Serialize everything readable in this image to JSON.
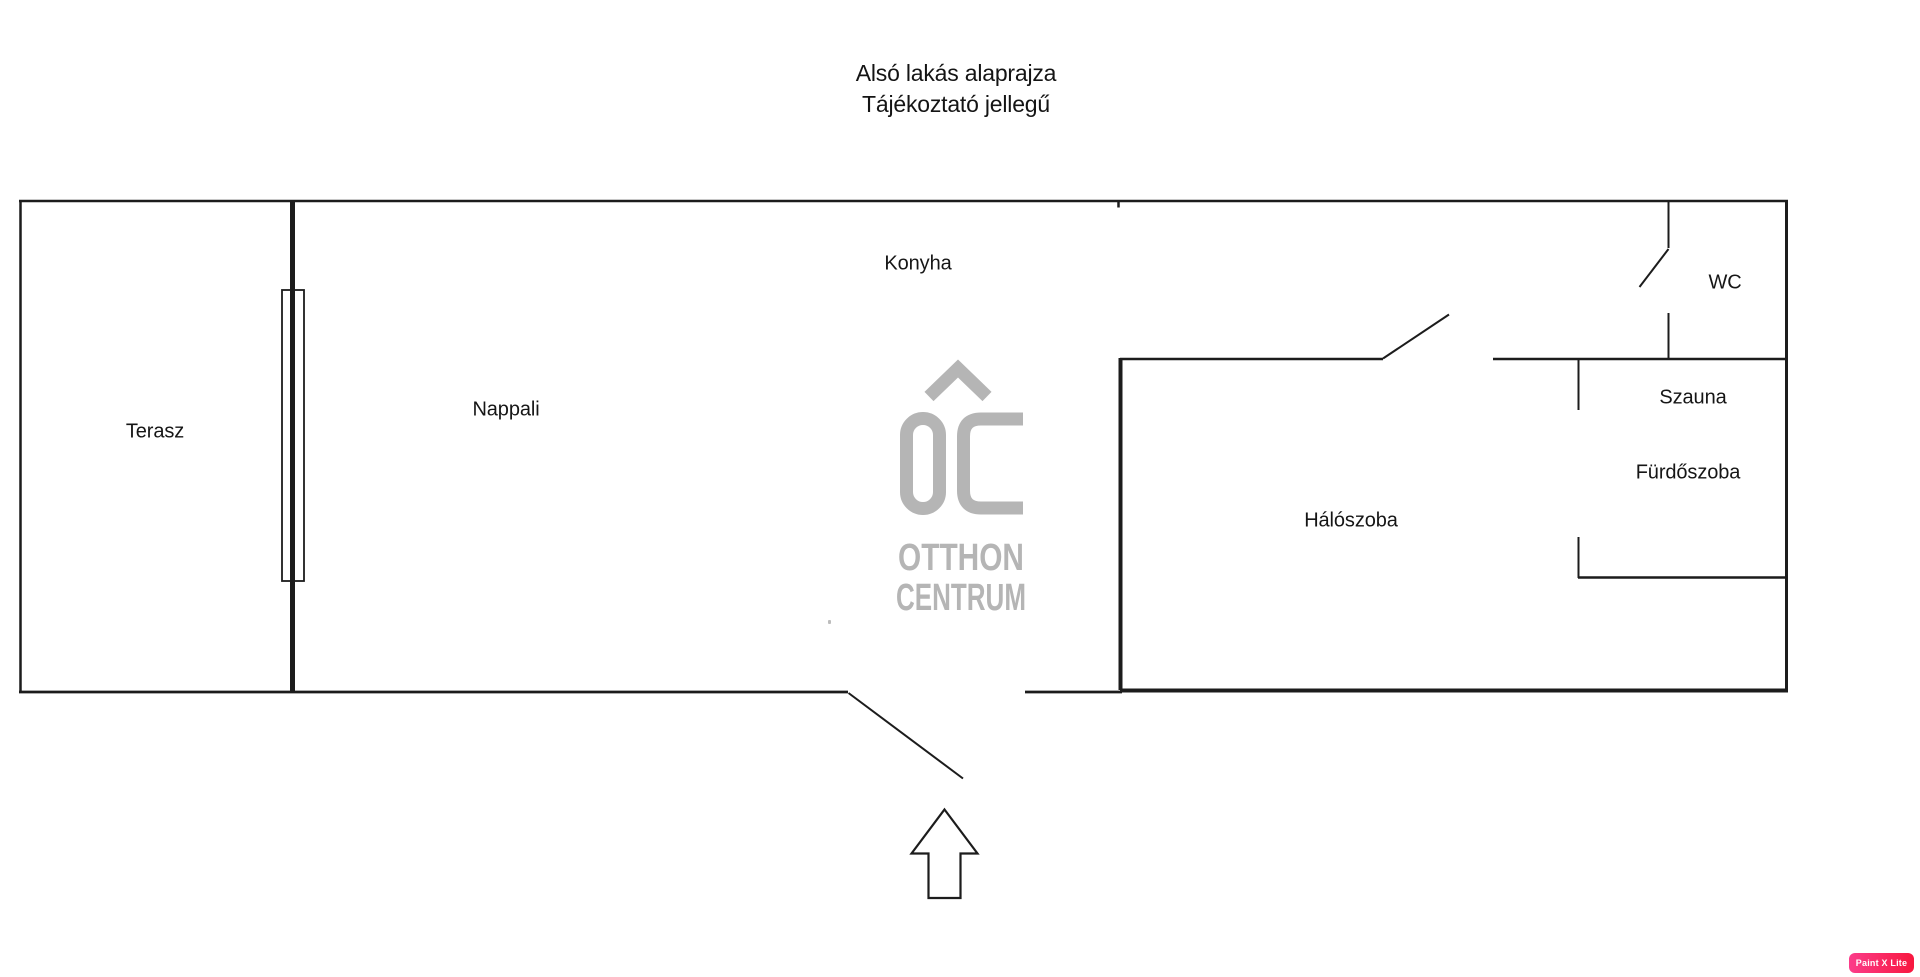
{
  "title": {
    "line1": "Alsó lakás alaprajza",
    "line2": "Tájékoztató jellegű"
  },
  "rooms": {
    "terasz": "Terasz",
    "nappali": "Nappali",
    "konyha": "Konyha",
    "wc": "WC",
    "szauna": "Szauna",
    "furdoszoba": "Fürdőszoba",
    "haloszoba": "Hálószoba"
  },
  "watermark_logo": {
    "word1": "OTTHON",
    "word2": "CENTRUM",
    "color": "#b5b5b5"
  },
  "badge": {
    "label": "Paint X Lite",
    "color_left": "#fb3c8a",
    "color_right": "#f8173e"
  },
  "colors": {
    "wall": "#1c1c1c",
    "label_text": "#161616"
  }
}
